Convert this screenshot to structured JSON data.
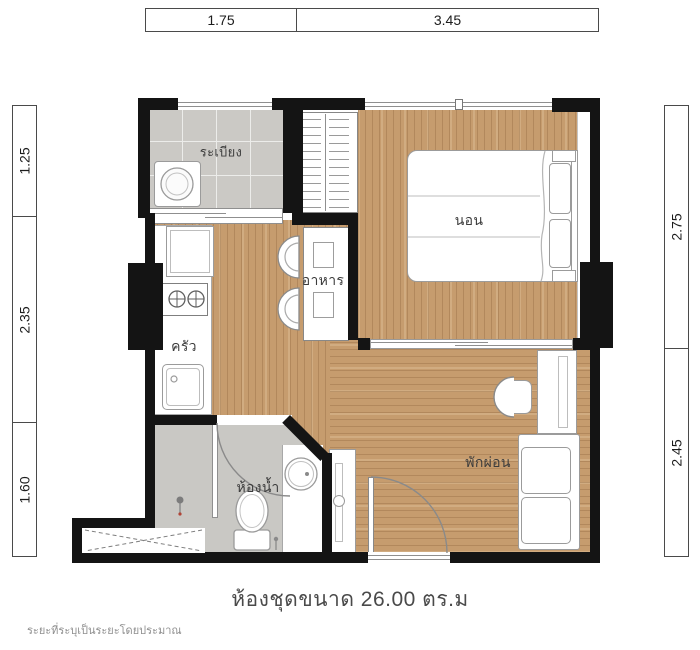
{
  "plan": {
    "caption": "ห้องชุดขนาด 26.00 ตร.ม",
    "footnote": "ระยะที่ระบุเป็นระยะโดยประมาณ"
  },
  "dimensions": {
    "top": [
      "1.75",
      "3.45"
    ],
    "left": [
      "1.25",
      "2.35",
      "1.60"
    ],
    "right": [
      "2.75",
      "2.45"
    ]
  },
  "rooms": {
    "balcony": "ระเบียง",
    "bedroom": "นอน",
    "dining": "อาหาร",
    "kitchen": "ครัว",
    "bathroom": "ห้องน้ำ",
    "living": "พักผ่อน"
  },
  "colors": {
    "wall": "#141414",
    "wood_floor": "#c69c6e",
    "tile_floor": "#cbc9c5",
    "fixture_stroke": "#8f8f8f",
    "text": "#3c3c3c"
  }
}
